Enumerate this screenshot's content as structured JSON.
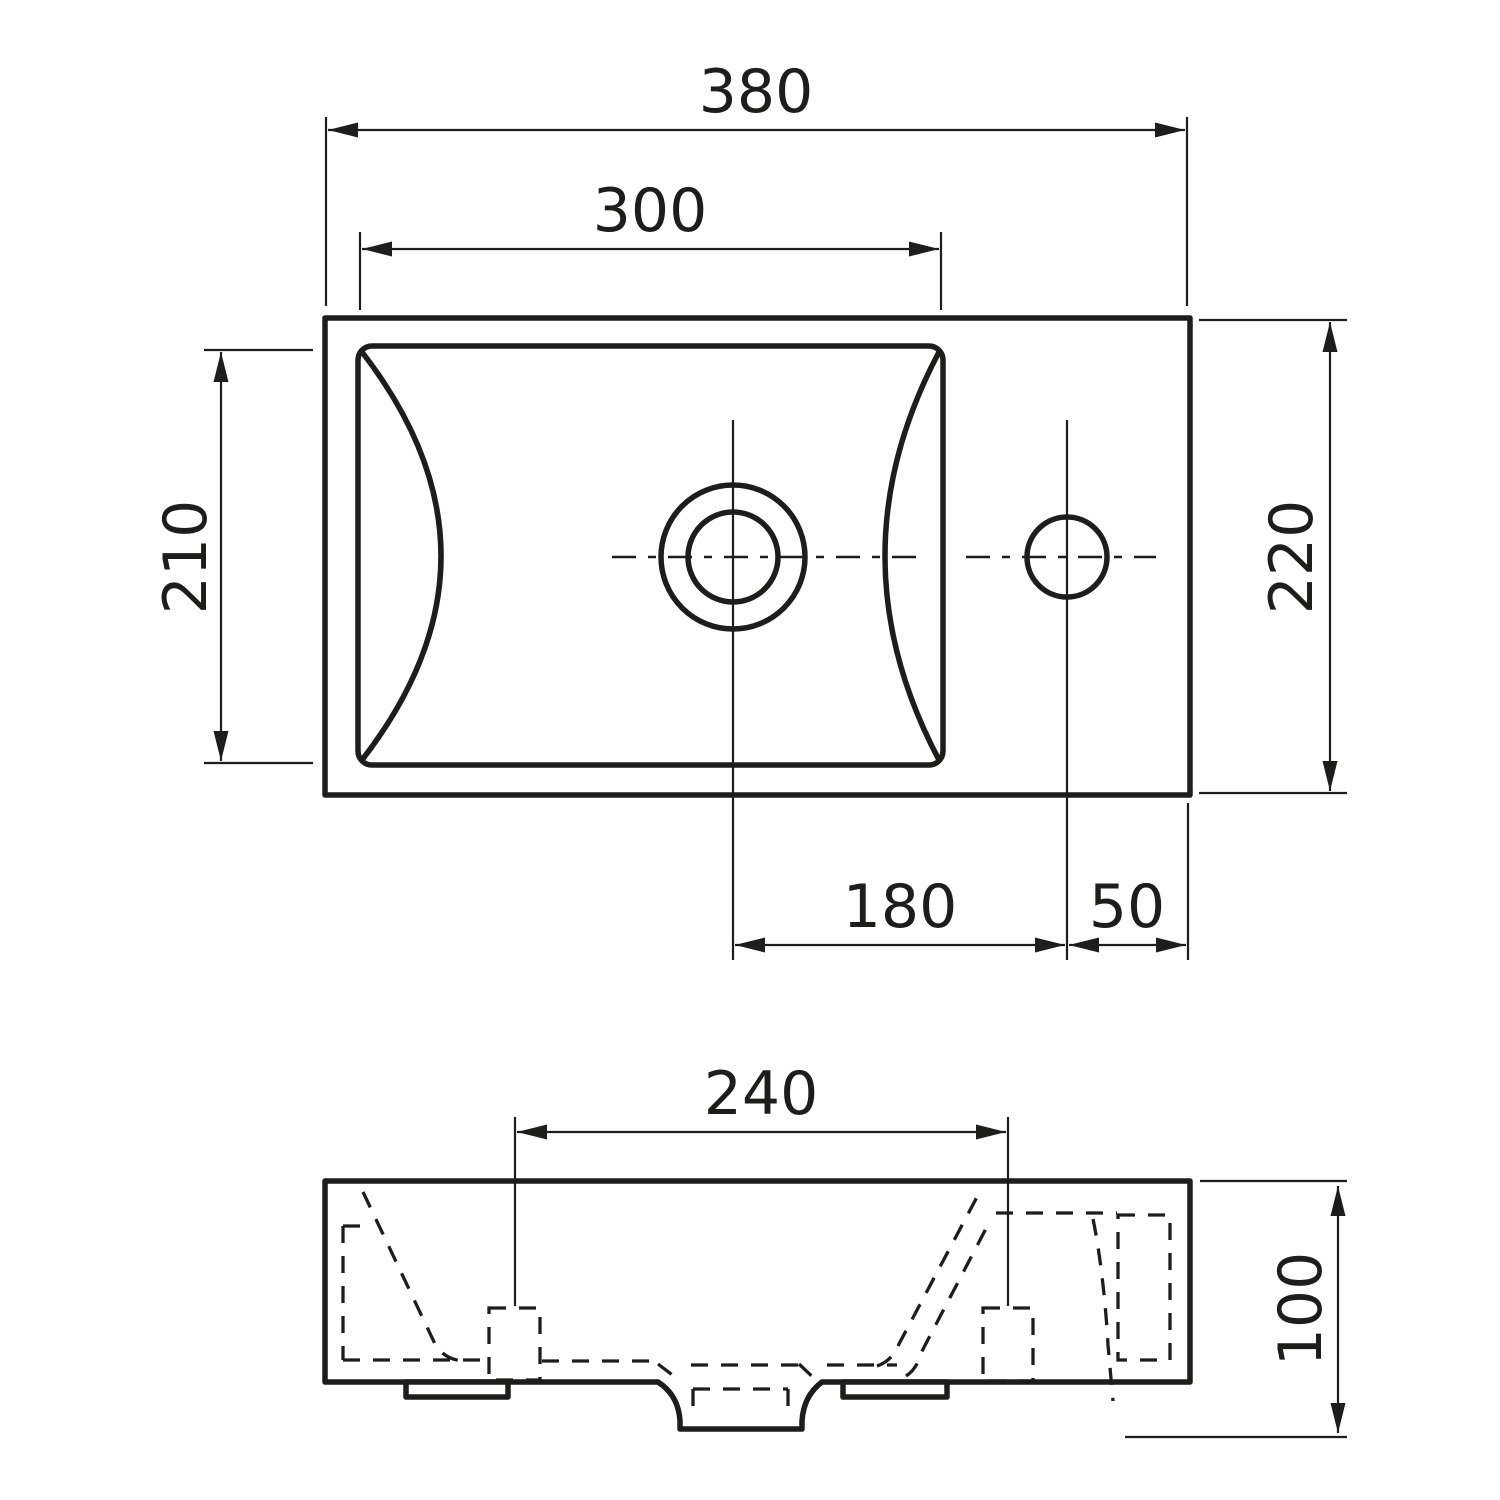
{
  "drawing": {
    "background": "#ffffff",
    "line_color": "#1d1d1b",
    "top_view": {
      "dim_overall_width": "380",
      "dim_basin_width": "300",
      "dim_basin_depth": "210",
      "dim_overall_depth": "220",
      "dim_drain_to_tap": "180",
      "dim_tap_to_edge": "50"
    },
    "front_view": {
      "dim_fixing_centers": "240",
      "dim_height": "100"
    }
  }
}
